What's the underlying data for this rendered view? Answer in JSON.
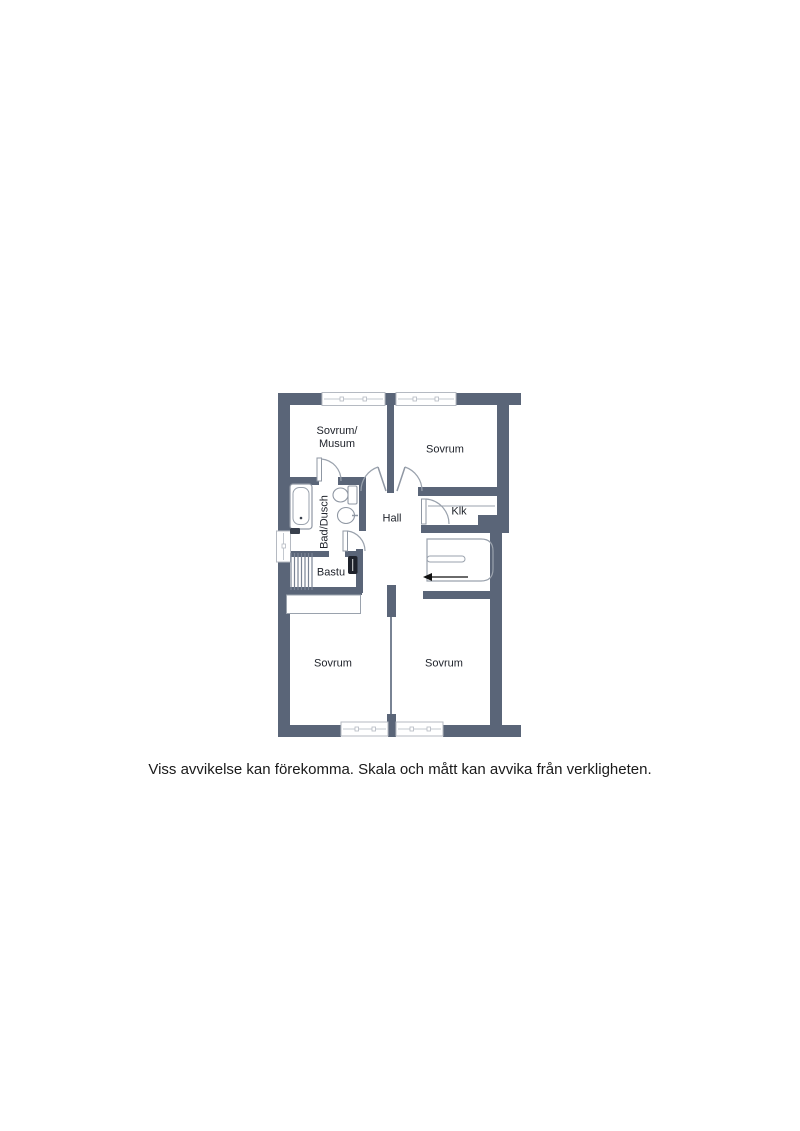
{
  "colors": {
    "wall": "#5A6578",
    "thin_partition": "#79839A",
    "fixture_outline": "#8F97A3",
    "window_frame": "#B5BAC2",
    "heater": "#1E222B",
    "arrow": "#111111",
    "text": "#20242C"
  },
  "rooms": {
    "sovrum_musum": {
      "line1": "Sovrum/",
      "line2": "Musum"
    },
    "sovrum_top": {
      "label": "Sovrum"
    },
    "bad_dusch": {
      "label": "Bad/Dusch"
    },
    "hall": {
      "label": "Hall"
    },
    "klk": {
      "label": "Klk"
    },
    "bastu": {
      "label": "Bastu"
    },
    "sovrum_bottom_left": {
      "label": "Sovrum"
    },
    "sovrum_bottom_right": {
      "label": "Sovrum"
    }
  },
  "footer": {
    "disclaimer": "Viss avvikelse kan förekomma. Skala och mått kan avvika från verkligheten."
  }
}
